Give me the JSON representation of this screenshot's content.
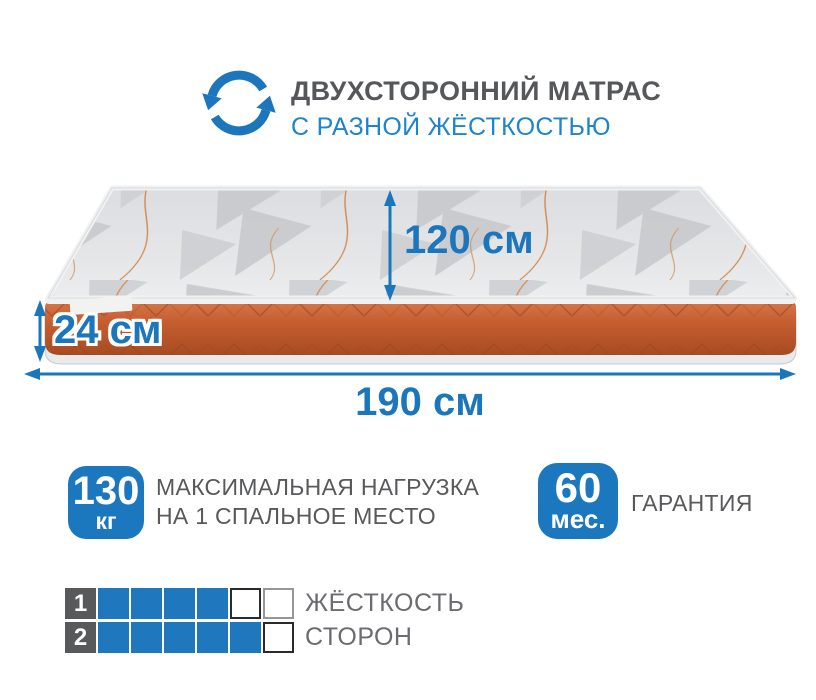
{
  "header": {
    "icon": "flip-rotate-arrows-icon",
    "title": "ДВУХСТОРОННИЙ МАТРАС",
    "subtitle": "С РАЗНОЙ ЖЁСТКОСТЬЮ"
  },
  "dimensions": {
    "depth": "120 см",
    "height": "24 см",
    "width": "190 см"
  },
  "max_load": {
    "value": "130",
    "unit": "кг",
    "line1": "МАКСИМАЛЬНАЯ НАГРУЗКА",
    "line2": "НА 1 СПАЛЬНОЕ МЕСТО"
  },
  "warranty": {
    "value": "60",
    "unit": "мес.",
    "label": "ГАРАНТИЯ"
  },
  "firmness": {
    "row1": {
      "num": "1",
      "cells": [
        "filled",
        "filled",
        "filled",
        "filled",
        "empty-dark",
        "empty-light"
      ]
    },
    "row2": {
      "num": "2",
      "cells": [
        "filled",
        "filled",
        "filled",
        "filled",
        "filled",
        "empty-dark"
      ]
    },
    "label1": "ЖЁСТКОСТЬ",
    "label2": "СТОРОН"
  },
  "colors": {
    "accent_blue": "#1b76bc",
    "subtitle_blue": "#1e84cc",
    "text_gray": "#58595b",
    "orange_side": "#c75f31",
    "top_fabric_gray": "#e2e3e6"
  }
}
